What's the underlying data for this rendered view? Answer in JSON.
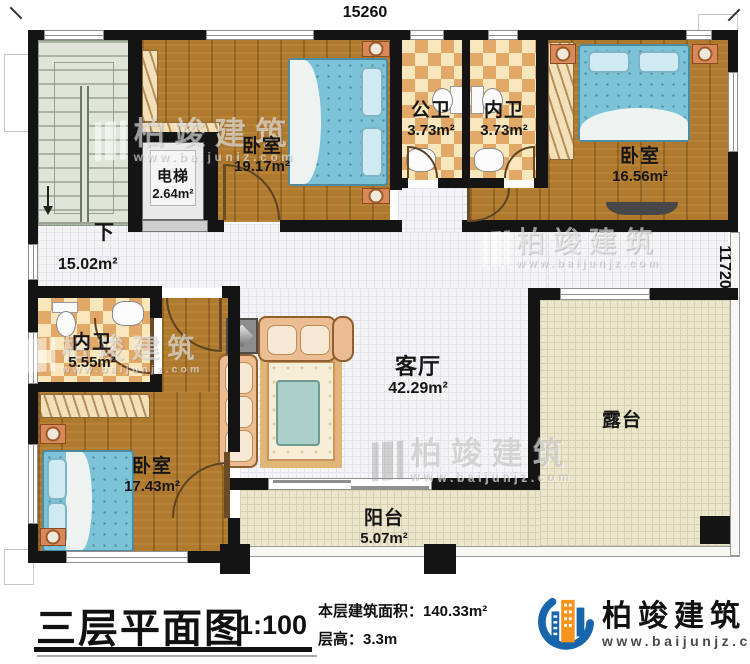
{
  "plan": {
    "dim_top": "15260",
    "dim_right": "11720",
    "stair_down": "下",
    "rooms": {
      "bedroom1": {
        "name": "卧室",
        "area": "19.17m²"
      },
      "elevator": {
        "name": "电梯",
        "area": "2.64m²"
      },
      "bath_public": {
        "name": "公卫",
        "area": "3.73m²"
      },
      "bath_inner_top": {
        "name": "内卫",
        "area": "3.73m²"
      },
      "bedroom2": {
        "name": "卧室",
        "area": "16.56m²"
      },
      "hall": {
        "area": "15.02m²"
      },
      "bath_inner_left": {
        "name": "内卫",
        "area": "5.55m²"
      },
      "bedroom3": {
        "name": "卧室",
        "area": "17.43m²"
      },
      "living": {
        "name": "客厅",
        "area": "42.29m²"
      },
      "terrace": {
        "name": "露台"
      },
      "balcony": {
        "name": "阳台",
        "area": "5.07m²"
      }
    }
  },
  "titlebar": {
    "title": "三层平面图",
    "scale": "1:100",
    "area_line": "本层建筑面积：140.33m²",
    "height_line": "层高：3.3m"
  },
  "brand": {
    "name": "柏竣建筑",
    "url": "www.baijunjz.com",
    "colors": {
      "blue": "#1766ad",
      "orange": "#f7941d"
    }
  }
}
